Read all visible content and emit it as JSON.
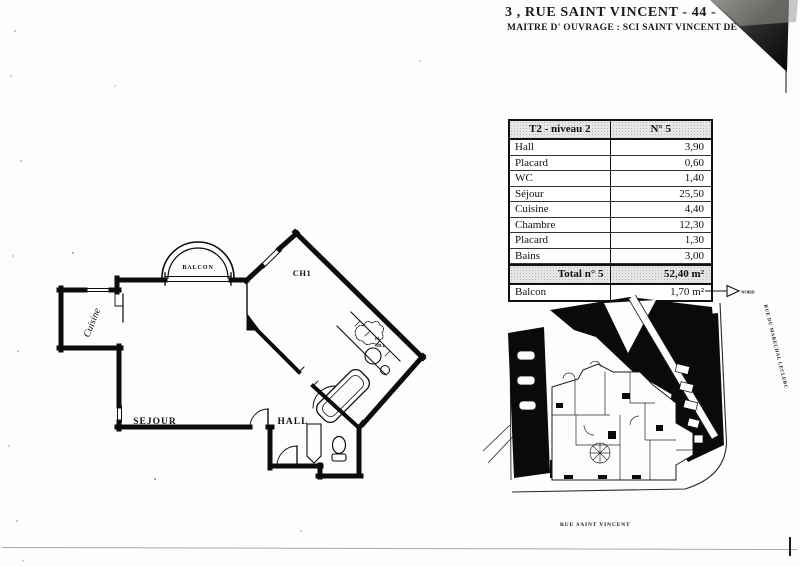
{
  "header": {
    "title_line1": "3 , RUE SAINT VINCENT   - 44 -",
    "title_line2": "MAITRE  D' OUVRAGE  : SCI SAINT VINCENT DE"
  },
  "area_table": {
    "header": {
      "left": "T2 - niveau 2",
      "right": "N° 5"
    },
    "rows": [
      {
        "label": "Hall",
        "value": "3,90"
      },
      {
        "label": "Placard",
        "value": "0,60"
      },
      {
        "label": "WC",
        "value": "1,40"
      },
      {
        "label": "Séjour",
        "value": "25,50"
      },
      {
        "label": "Cuisine",
        "value": "4,40"
      },
      {
        "label": "Chambre",
        "value": "12,30"
      },
      {
        "label": "Placard",
        "value": "1,30"
      },
      {
        "label": "Bains",
        "value": "3,00"
      }
    ],
    "total": {
      "label": "Total n° 5",
      "value": "52,40 m²"
    },
    "balcony": {
      "label": "Balcon",
      "value": "1,70 m²"
    }
  },
  "floor_plan": {
    "labels": {
      "balcony": "BALCON",
      "bedroom": "CH1",
      "kitchen": "Cuisine",
      "living": "SEJOUR",
      "hall": "HALL",
      "closet_small_1": "EL",
      "closet_small_2": "MLL"
    }
  },
  "site_plan": {
    "north_label": "NORD",
    "street_right": "RUE DU MARECHAL LECLERC",
    "street_bottom": "RUE SAINT VINCENT"
  },
  "colors": {
    "ink": "#111111",
    "paper": "#ffffff",
    "shade": "#e6e6e4"
  }
}
